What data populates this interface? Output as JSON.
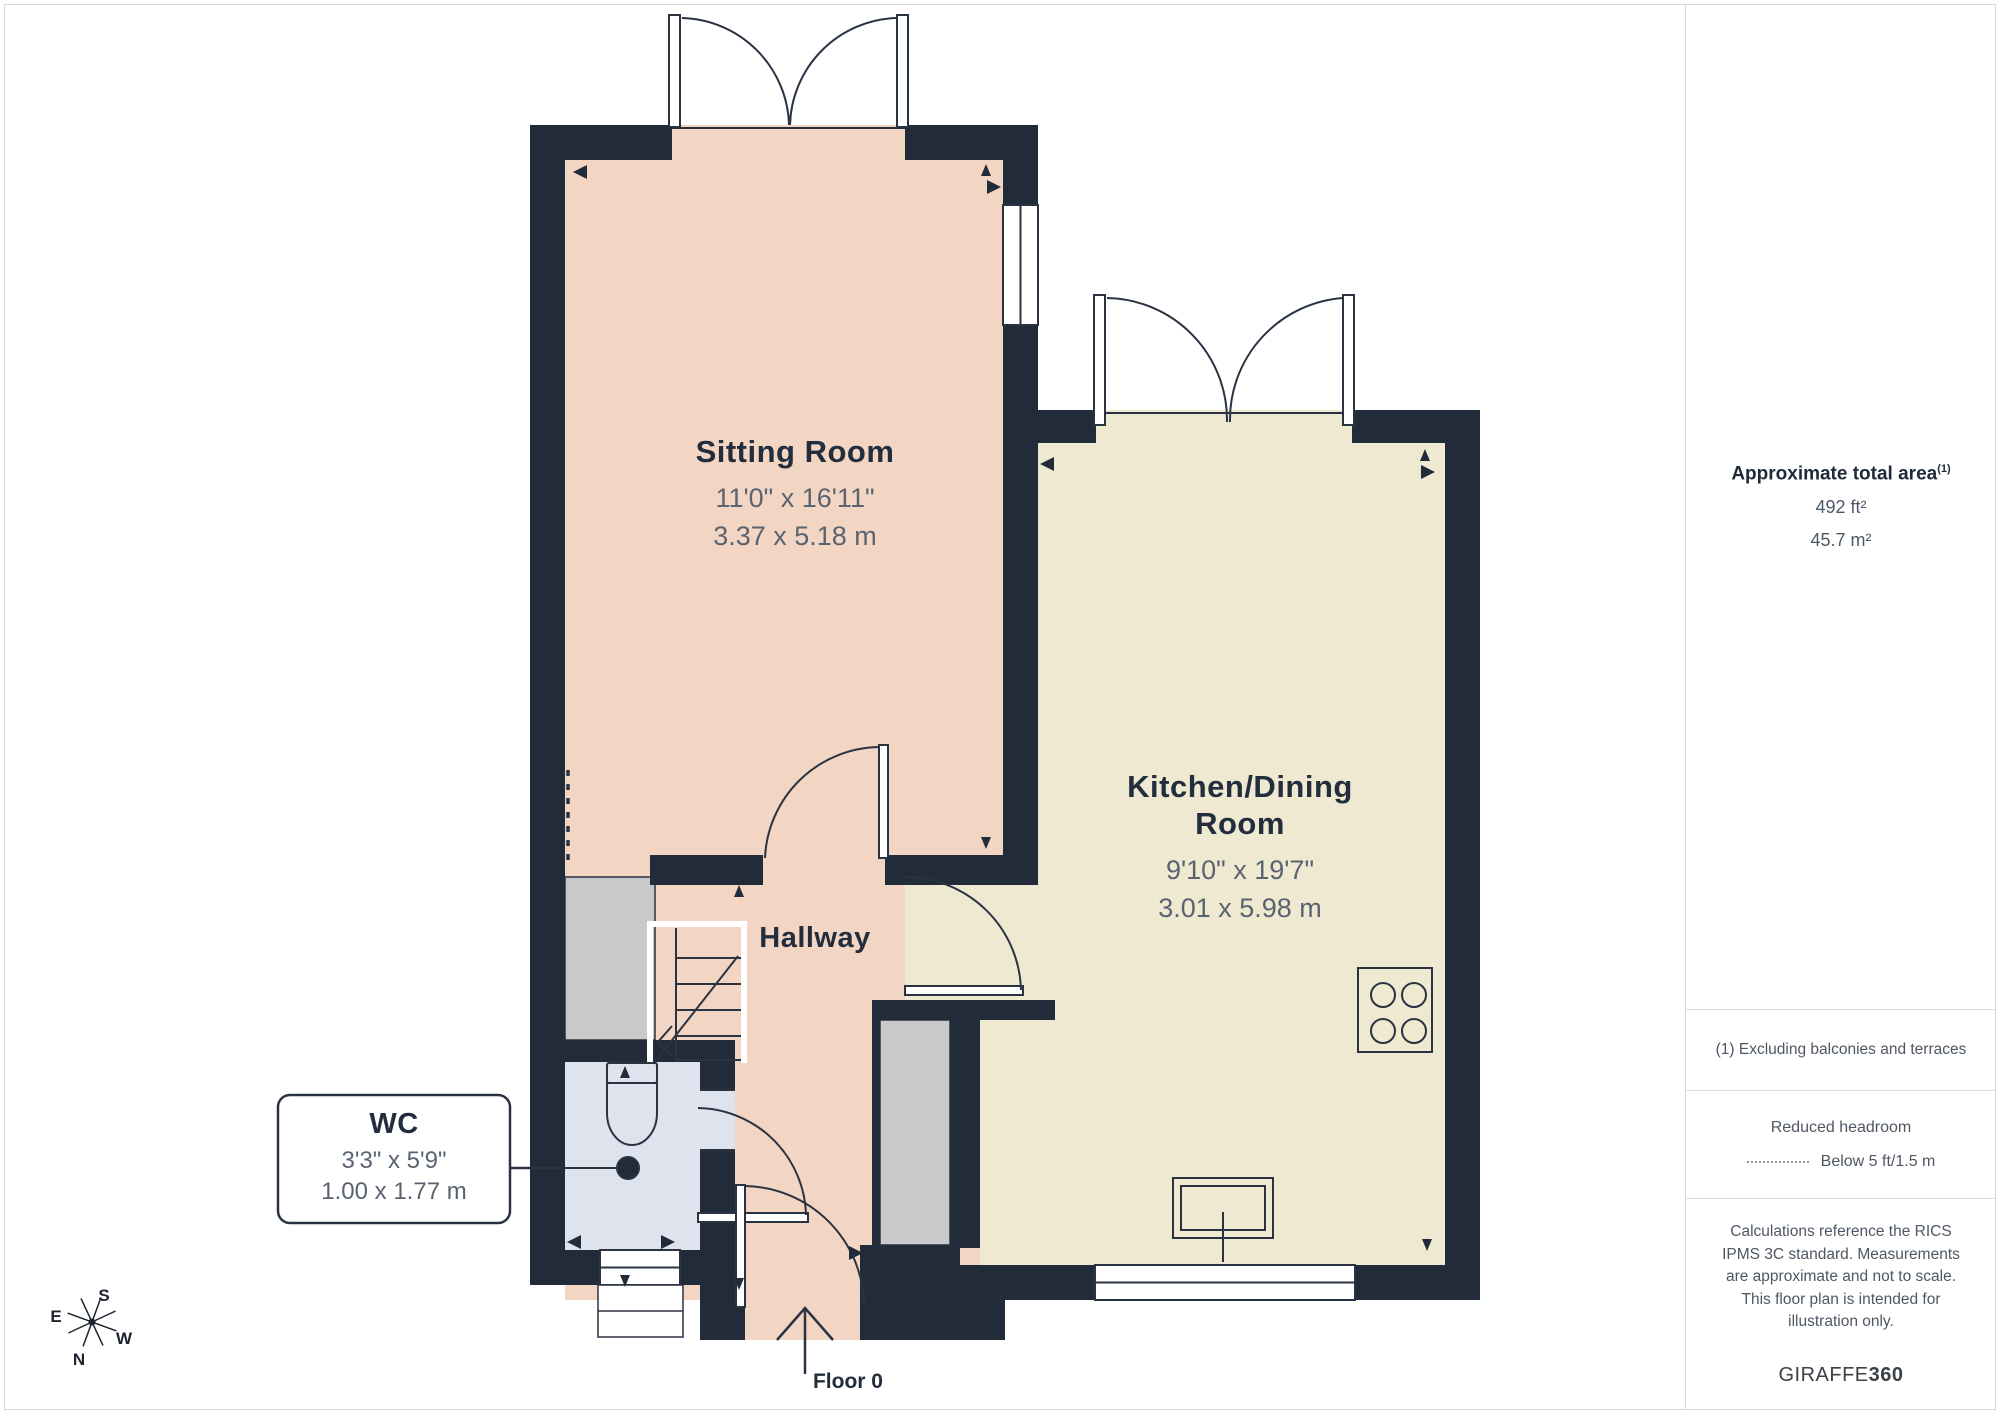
{
  "floorplan": {
    "floor_label": "Floor 0",
    "rooms": {
      "sitting_room": {
        "name": "Sitting Room",
        "dims_ft": "11'0\" x 16'11\"",
        "dims_m": "3.37 x 5.18 m"
      },
      "kitchen": {
        "name_line1": "Kitchen/Dining",
        "name_line2": "Room",
        "dims_ft": "9'10\" x 19'7\"",
        "dims_m": "3.01 x 5.98 m"
      },
      "hallway": {
        "name": "Hallway"
      },
      "wc": {
        "name": "WC",
        "dims_ft": "3'3\" x 5'9\"",
        "dims_m": "1.00 x 1.77 m"
      }
    },
    "compass": {
      "n": "N",
      "s": "S",
      "e": "E",
      "w": "W"
    },
    "colors": {
      "wall": "#212b39",
      "sitting_room_fill": "#f3d5c3",
      "kitchen_fill": "#efe9d2",
      "wc_fill": "#dfe3ee",
      "storage_fill": "#c9c9c9",
      "title_text": "#222d3d",
      "dims_text": "#5a6370"
    }
  },
  "sidebar": {
    "area": {
      "title": "Approximate total area",
      "superscript": "(1)",
      "value_ft": "492 ft²",
      "value_m": "45.7 m²"
    },
    "note_excluding": "(1) Excluding balconies and terraces",
    "headroom": {
      "title": "Reduced headroom",
      "legend": "Below 5 ft/1.5 m"
    },
    "disclaimer": "Calculations reference the RICS IPMS 3C standard. Measurements are approximate and not to scale. This floor plan is intended for illustration only.",
    "brand": {
      "name": "GIRAFFE",
      "suffix": "360"
    }
  }
}
